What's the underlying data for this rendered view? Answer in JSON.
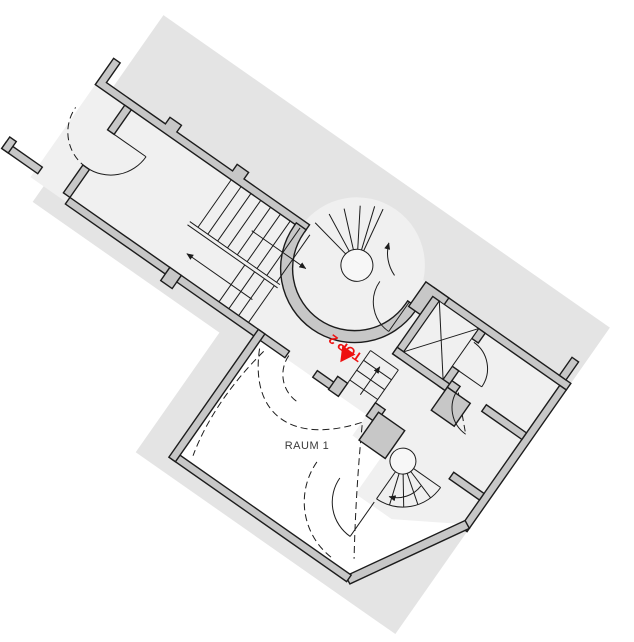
{
  "drawing": {
    "type": "architectural-floor-plan",
    "labels": {
      "room": "RAUM 1",
      "unit_marker": "TOP 2"
    },
    "features": [
      "site-footprint-rotated",
      "main-straight-stair",
      "tower-winder-stair",
      "secondary-winder-stair",
      "small-flight",
      "elevator-shaft-x",
      "door-swing-arcs",
      "dashed-vault-lines"
    ],
    "colors": {
      "site_bg": "#e4e4e4",
      "floor": "#f0f0f0",
      "room_floor": "#ffffff",
      "wall_fill": "#c7c7c7",
      "outline": "#1c1c1c",
      "marker_red": "#ee1111",
      "label_gray": "#3a3a3a"
    },
    "icons": {
      "unit_direction_marker": "red-triangle",
      "stair_direction": "arrow"
    }
  }
}
